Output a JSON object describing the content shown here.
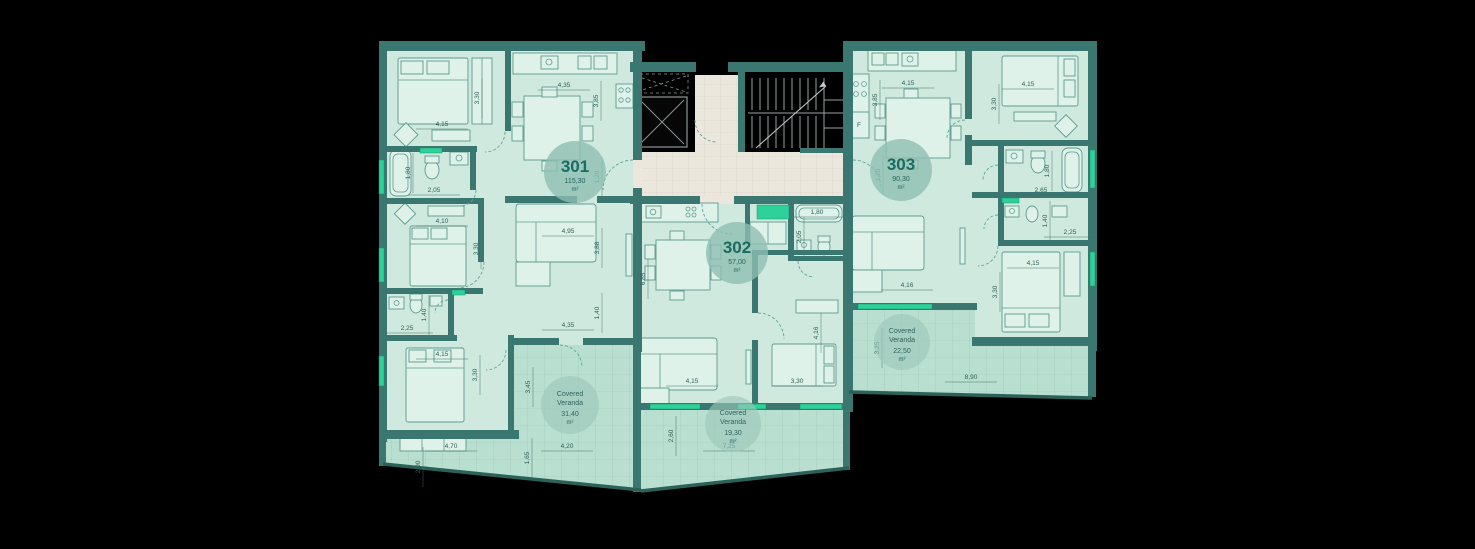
{
  "colors": {
    "background": "#000000",
    "wall": "#3b7771",
    "floor": "#cfe9df",
    "veranda_floor": "#b9dfd1",
    "lobby_floor": "#ebe7dd",
    "accent_green": "#2fd19b",
    "badge_fill": "#8fbeb2",
    "badge_text": "#1a6b61",
    "dimension_text": "#2f5e57"
  },
  "apartments": [
    {
      "number": "301",
      "area": "115,30",
      "unit": "m²"
    },
    {
      "number": "302",
      "area": "57,00",
      "unit": "m²"
    },
    {
      "number": "303",
      "area": "90,30",
      "unit": "m²"
    }
  ],
  "verandas": [
    {
      "title": "Covered",
      "subtitle": "Veranda",
      "area": "31,40",
      "unit": "m²"
    },
    {
      "title": "Covered",
      "subtitle": "Veranda",
      "area": "19,30",
      "unit": "m²"
    },
    {
      "title": "Covered",
      "subtitle": "Veranda",
      "area": "22,50",
      "unit": "m²"
    }
  ],
  "labels": {
    "fridge": "F"
  },
  "dimension_labels": [
    {
      "t": "4,15",
      "x": 442,
      "y": 126,
      "v": false
    },
    {
      "t": "3,30",
      "x": 479,
      "y": 98,
      "v": true
    },
    {
      "t": "4,35",
      "x": 564,
      "y": 87,
      "v": false
    },
    {
      "t": "3,85",
      "x": 598,
      "y": 101,
      "v": true
    },
    {
      "t": "1,80",
      "x": 410,
      "y": 173,
      "v": true
    },
    {
      "t": "2,05",
      "x": 434,
      "y": 192,
      "v": false
    },
    {
      "t": "1,20",
      "x": 599,
      "y": 177,
      "v": true
    },
    {
      "t": "4,10",
      "x": 442,
      "y": 223,
      "v": false
    },
    {
      "t": "3,30",
      "x": 478,
      "y": 249,
      "v": true
    },
    {
      "t": "4,95",
      "x": 568,
      "y": 233,
      "v": false
    },
    {
      "t": "3,88",
      "x": 599,
      "y": 248,
      "v": true
    },
    {
      "t": "1,40",
      "x": 599,
      "y": 313,
      "v": true
    },
    {
      "t": "4,35",
      "x": 568,
      "y": 327,
      "v": false
    },
    {
      "t": "2,25",
      "x": 407,
      "y": 330,
      "v": false
    },
    {
      "t": "1,40",
      "x": 426,
      "y": 315,
      "v": true
    },
    {
      "t": "4,15",
      "x": 442,
      "y": 356,
      "v": false
    },
    {
      "t": "3,30",
      "x": 477,
      "y": 375,
      "v": true
    },
    {
      "t": "3,45",
      "x": 530,
      "y": 387,
      "v": true
    },
    {
      "t": "4,70",
      "x": 451,
      "y": 448,
      "v": false
    },
    {
      "t": "4,20",
      "x": 567,
      "y": 448,
      "v": false
    },
    {
      "t": "2,00",
      "x": 420,
      "y": 467,
      "v": true
    },
    {
      "t": "1,65",
      "x": 529,
      "y": 458,
      "v": true
    },
    {
      "t": "1,80",
      "x": 817,
      "y": 214,
      "v": false
    },
    {
      "t": "2,05",
      "x": 801,
      "y": 237,
      "v": true
    },
    {
      "t": "6,85",
      "x": 645,
      "y": 279,
      "v": true
    },
    {
      "t": "4,16",
      "x": 818,
      "y": 333,
      "v": true
    },
    {
      "t": "4,15",
      "x": 692,
      "y": 383,
      "v": false
    },
    {
      "t": "3,30",
      "x": 797,
      "y": 383,
      "v": false
    },
    {
      "t": "2,60",
      "x": 673,
      "y": 436,
      "v": true
    },
    {
      "t": "7,25",
      "x": 729,
      "y": 448,
      "v": false
    },
    {
      "t": "4,15",
      "x": 908,
      "y": 85,
      "v": false
    },
    {
      "t": "3,85",
      "x": 877,
      "y": 100,
      "v": true
    },
    {
      "t": "F",
      "x": 859,
      "y": 127,
      "v": false
    },
    {
      "t": "4,15",
      "x": 1028,
      "y": 86,
      "v": false
    },
    {
      "t": "3,30",
      "x": 996,
      "y": 104,
      "v": true
    },
    {
      "t": "1,20",
      "x": 880,
      "y": 175,
      "v": true
    },
    {
      "t": "1,80",
      "x": 1049,
      "y": 171,
      "v": true
    },
    {
      "t": "2,65",
      "x": 1041,
      "y": 192,
      "v": false
    },
    {
      "t": "1,40",
      "x": 1047,
      "y": 221,
      "v": true
    },
    {
      "t": "2,25",
      "x": 1070,
      "y": 234,
      "v": false
    },
    {
      "t": "4,16",
      "x": 907,
      "y": 287,
      "v": false
    },
    {
      "t": "4,15",
      "x": 1033,
      "y": 265,
      "v": false
    },
    {
      "t": "3,30",
      "x": 997,
      "y": 292,
      "v": true
    },
    {
      "t": "3,25",
      "x": 879,
      "y": 348,
      "v": true
    },
    {
      "t": "8,90",
      "x": 971,
      "y": 379,
      "v": false
    }
  ]
}
